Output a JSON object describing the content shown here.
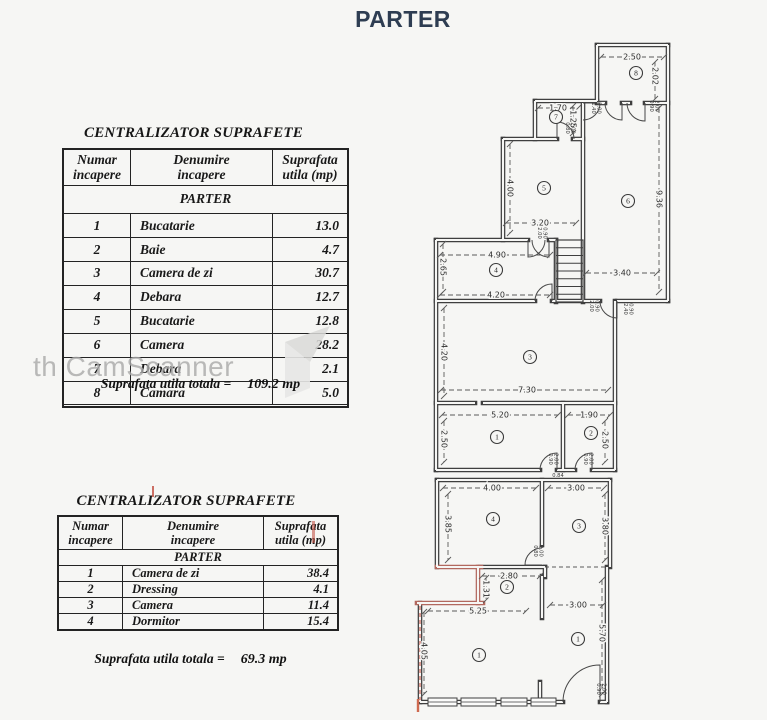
{
  "page": {
    "heading": "PARTER"
  },
  "watermark": {
    "text": "th CamScanner",
    "shape1": "287,344 332,328 312,364",
    "shape2": "287,344 312,364 312,390 287,400"
  },
  "tables": [
    {
      "title": "CENTRALIZATOR SUPRAFETE",
      "headers": [
        "Numar\nincapere",
        "Denumire\nincapere",
        "Suprafata\nutila (mp)"
      ],
      "section": "PARTER",
      "rows": [
        [
          "1",
          "Bucatarie",
          "13.0"
        ],
        [
          "2",
          "Baie",
          "4.7"
        ],
        [
          "3",
          "Camera de zi",
          "30.7"
        ],
        [
          "4",
          "Debara",
          "12.7"
        ],
        [
          "5",
          "Bucatarie",
          "12.8"
        ],
        [
          "6",
          "Camera",
          "28.2"
        ],
        [
          "7",
          "Debara",
          "2.1"
        ],
        [
          "8",
          "Camara",
          "5.0"
        ]
      ],
      "total_label": "Suprafata utila totala =",
      "total_value": "109.2 mp"
    },
    {
      "title": "CENTRALIZATOR SUPRAFETE",
      "headers": [
        "Numar\nincapere",
        "Denumire\nincapere",
        "Suprafata\nutila (mp)"
      ],
      "section": "PARTER",
      "rows": [
        [
          "1",
          "Camera de zi",
          "38.4"
        ],
        [
          "2",
          "Dressing",
          "4.1"
        ],
        [
          "3",
          "Camera",
          "11.4"
        ],
        [
          "4",
          "Dormitor",
          "15.4"
        ]
      ],
      "total_label": "Suprafata utila totala =",
      "total_value": "69.3 mp"
    }
  ],
  "floorplan": {
    "line_color": "#3f3f3f",
    "paper_color": "#f6f6f4",
    "red_color": "#b2685e",
    "walls": [
      [
        597,
        45,
        668,
        45
      ],
      [
        597,
        45,
        597,
        101
      ],
      [
        668,
        45,
        668,
        301
      ],
      [
        597,
        103,
        605,
        103
      ],
      [
        622,
        103,
        630,
        103
      ],
      [
        645,
        103,
        668,
        103
      ],
      [
        535,
        101,
        597,
        101
      ],
      [
        535,
        101,
        535,
        139
      ],
      [
        583,
        103,
        583,
        302
      ],
      [
        503,
        139,
        557,
        139
      ],
      [
        573,
        139,
        583,
        139
      ],
      [
        503,
        139,
        503,
        240
      ],
      [
        436,
        240,
        528,
        240
      ],
      [
        549,
        240,
        556,
        240
      ],
      [
        436,
        240,
        436,
        470
      ],
      [
        556,
        240,
        556,
        302
      ],
      [
        436,
        301,
        535,
        301
      ],
      [
        552,
        301,
        600,
        301
      ],
      [
        617,
        301,
        668,
        301
      ],
      [
        615,
        301,
        615,
        470
      ],
      [
        436,
        403,
        475,
        403
      ],
      [
        483,
        403,
        615,
        403
      ],
      [
        563,
        403,
        563,
        470
      ],
      [
        436,
        470,
        540,
        470
      ],
      [
        557,
        470,
        575,
        470
      ],
      [
        592,
        470,
        615,
        470
      ],
      [
        437,
        480,
        610,
        480
      ],
      [
        437,
        480,
        437,
        567
      ],
      [
        542,
        480,
        542,
        545
      ],
      [
        610,
        480,
        610,
        567
      ],
      [
        480,
        567,
        545,
        567
      ],
      [
        545,
        567,
        545,
        577
      ],
      [
        542,
        576,
        542,
        618
      ],
      [
        420,
        603,
        420,
        702
      ],
      [
        607,
        567,
        607,
        702
      ],
      [
        420,
        702,
        563,
        702
      ],
      [
        600,
        702,
        607,
        702
      ],
      [
        540,
        682,
        540,
        702
      ]
    ],
    "red_walls": [
      [
        437,
        567,
        481,
        567
      ],
      [
        478,
        567,
        478,
        603
      ],
      [
        417,
        603,
        483,
        603
      ]
    ],
    "dashed_walls": [
      [
        545,
        567,
        607,
        567
      ]
    ],
    "red_dashed": [
      [
        420,
        606,
        420,
        700
      ]
    ],
    "red_ticks": [
      [
        418,
        699,
        418,
        712
      ]
    ],
    "door_arcs": [
      "M622,103 L622,120 A17,17 0 0 1 605,103",
      "M645,103 L645,121 A18,18 0 0 1 627,103",
      "M583,103 L600,103 A17,17 0 0 1 583,120",
      "M557,139 L557,122 A17,17 0 0 1 574,139",
      "M528,240 L528,257 A17,17 0 0 0 545,240",
      "M549,240 L549,257 A17,17 0 0 1 532,240",
      "M552,301 L552,284 A17,17 0 0 0 535,301",
      "M617,301 L617,318 A17,17 0 0 1 600,301",
      "M557,470 L557,453 A17,17 0 0 0 540,470",
      "M592,470 L592,453 A17,17 0 0 0 575,470",
      "M542,565 L525,565 A17,17 0 0 1 542,548",
      "M600,702 L600,665 A37,37 0 0 0 563,702"
    ],
    "stairs": {
      "x": 556,
      "y": 240,
      "w": 27,
      "h": 62,
      "treads": 8
    },
    "windows": {
      "y": 698,
      "h": 8,
      "slots": [
        [
          428,
          457
        ],
        [
          461,
          496
        ],
        [
          501,
          527
        ],
        [
          531,
          556
        ]
      ]
    },
    "dims": [
      {
        "t": "2.50",
        "x": 632,
        "y": 57,
        "rot": 0,
        "l": [
          601,
          57,
          664,
          57
        ]
      },
      {
        "t": "2.02",
        "x": 655,
        "y": 76,
        "rot": 90,
        "l": [
          655,
          62,
          655,
          99
        ]
      },
      {
        "t": "1.70",
        "x": 558,
        "y": 108,
        "rot": 0,
        "l": [
          538,
          108,
          578,
          108
        ]
      },
      {
        "t": "1.25",
        "x": 573,
        "y": 119,
        "rot": 90,
        "l": [
          573,
          106,
          573,
          133
        ]
      },
      {
        "t": "9.36",
        "x": 659,
        "y": 199,
        "rot": 90,
        "l": [
          659,
          108,
          659,
          292
        ]
      },
      {
        "t": "4.00",
        "x": 510,
        "y": 188,
        "rot": 90,
        "l": [
          510,
          144,
          510,
          233
        ]
      },
      {
        "t": "3.20",
        "x": 540,
        "y": 223,
        "rot": 0,
        "l": [
          506,
          223,
          576,
          223
        ]
      },
      {
        "t": "4.90",
        "x": 497,
        "y": 255,
        "rot": 0,
        "l": [
          440,
          255,
          550,
          255
        ]
      },
      {
        "t": "2.65",
        "x": 443,
        "y": 267,
        "rot": 90,
        "l": [
          443,
          244,
          443,
          292
        ]
      },
      {
        "t": "4.20",
        "x": 496,
        "y": 295,
        "rot": 0,
        "l": [
          440,
          295,
          550,
          295
        ]
      },
      {
        "t": "3.40",
        "x": 622,
        "y": 273,
        "rot": 0,
        "l": [
          586,
          273,
          657,
          273
        ]
      },
      {
        "t": "4.20",
        "x": 444,
        "y": 352,
        "rot": 90,
        "l": [
          444,
          308,
          444,
          396
        ]
      },
      {
        "t": "7.30",
        "x": 527,
        "y": 390,
        "rot": 0,
        "l": [
          441,
          390,
          608,
          390
        ]
      },
      {
        "t": "5.20",
        "x": 500,
        "y": 415,
        "rot": 0,
        "l": [
          442,
          415,
          558,
          415
        ]
      },
      {
        "t": "2.50",
        "x": 444,
        "y": 439,
        "rot": 90,
        "l": [
          444,
          421,
          444,
          462
        ]
      },
      {
        "t": "1.90",
        "x": 589,
        "y": 415,
        "rot": 0,
        "l": [
          568,
          415,
          610,
          415
        ]
      },
      {
        "t": "2.50",
        "x": 605,
        "y": 440,
        "rot": 90,
        "l": [
          605,
          421,
          605,
          462
        ]
      },
      {
        "t": "4.00",
        "x": 492,
        "y": 488,
        "rot": 0,
        "l": [
          443,
          488,
          536,
          488
        ]
      },
      {
        "t": "3.85",
        "x": 448,
        "y": 524,
        "rot": 90,
        "l": [
          448,
          494,
          448,
          560
        ]
      },
      {
        "t": "3.00",
        "x": 576,
        "y": 488,
        "rot": 0,
        "l": [
          548,
          488,
          604,
          488
        ]
      },
      {
        "t": "3.80",
        "x": 605,
        "y": 526,
        "rot": 90,
        "l": [
          605,
          494,
          605,
          560
        ]
      },
      {
        "t": "2.80",
        "x": 509,
        "y": 576,
        "rot": 0,
        "l": [
          482,
          576,
          540,
          576
        ]
      },
      {
        "t": "1.31",
        "x": 486,
        "y": 589,
        "rot": 90,
        "l": [
          486,
          578,
          486,
          600
        ]
      },
      {
        "t": "5.25",
        "x": 478,
        "y": 611,
        "rot": 0,
        "l": [
          428,
          611,
          526,
          611
        ]
      },
      {
        "t": "3.00",
        "x": 578,
        "y": 605,
        "rot": 0,
        "l": [
          550,
          605,
          603,
          605
        ]
      },
      {
        "t": "4.05",
        "x": 424,
        "y": 651,
        "rot": 90,
        "l": [
          424,
          612,
          424,
          694
        ]
      },
      {
        "t": "5.70",
        "x": 602,
        "y": 633,
        "rot": 90,
        "l": [
          602,
          580,
          602,
          694
        ]
      }
    ],
    "rooms": [
      {
        "n": "8",
        "x": 636,
        "y": 73
      },
      {
        "n": "7",
        "x": 556,
        "y": 117
      },
      {
        "n": "5",
        "x": 544,
        "y": 188
      },
      {
        "n": "6",
        "x": 628,
        "y": 201
      },
      {
        "n": "4",
        "x": 496,
        "y": 270
      },
      {
        "n": "3",
        "x": 530,
        "y": 357
      },
      {
        "n": "1",
        "x": 497,
        "y": 437
      },
      {
        "n": "2",
        "x": 591,
        "y": 433
      },
      {
        "n": "4",
        "x": 493,
        "y": 519
      },
      {
        "n": "3",
        "x": 579,
        "y": 526
      },
      {
        "n": "2",
        "x": 507,
        "y": 587
      },
      {
        "n": "1",
        "x": 479,
        "y": 655
      },
      {
        "n": "1",
        "x": 578,
        "y": 639
      }
    ],
    "door_labels": [
      {
        "t": "1.40 2.00",
        "x": 592,
        "y": 108
      },
      {
        "t": "0.90 2.00",
        "x": 650,
        "y": 106
      },
      {
        "t": "0.80 2.00",
        "x": 566,
        "y": 128
      },
      {
        "t": "2.00 0.90",
        "x": 538,
        "y": 233
      },
      {
        "t": "2.00 0.90",
        "x": 590,
        "y": 306
      },
      {
        "t": "2.40 0.90",
        "x": 624,
        "y": 309
      },
      {
        "t": "0.90 2.00",
        "x": 549,
        "y": 459
      },
      {
        "t": "0.90 2.00",
        "x": 584,
        "y": 459
      },
      {
        "t": "0.84",
        "x": 558,
        "y": 477,
        "rot": 0
      },
      {
        "t": "0.80 2.00",
        "x": 534,
        "y": 551
      },
      {
        "t": "0.90 2.00",
        "x": 597,
        "y": 689
      }
    ]
  }
}
